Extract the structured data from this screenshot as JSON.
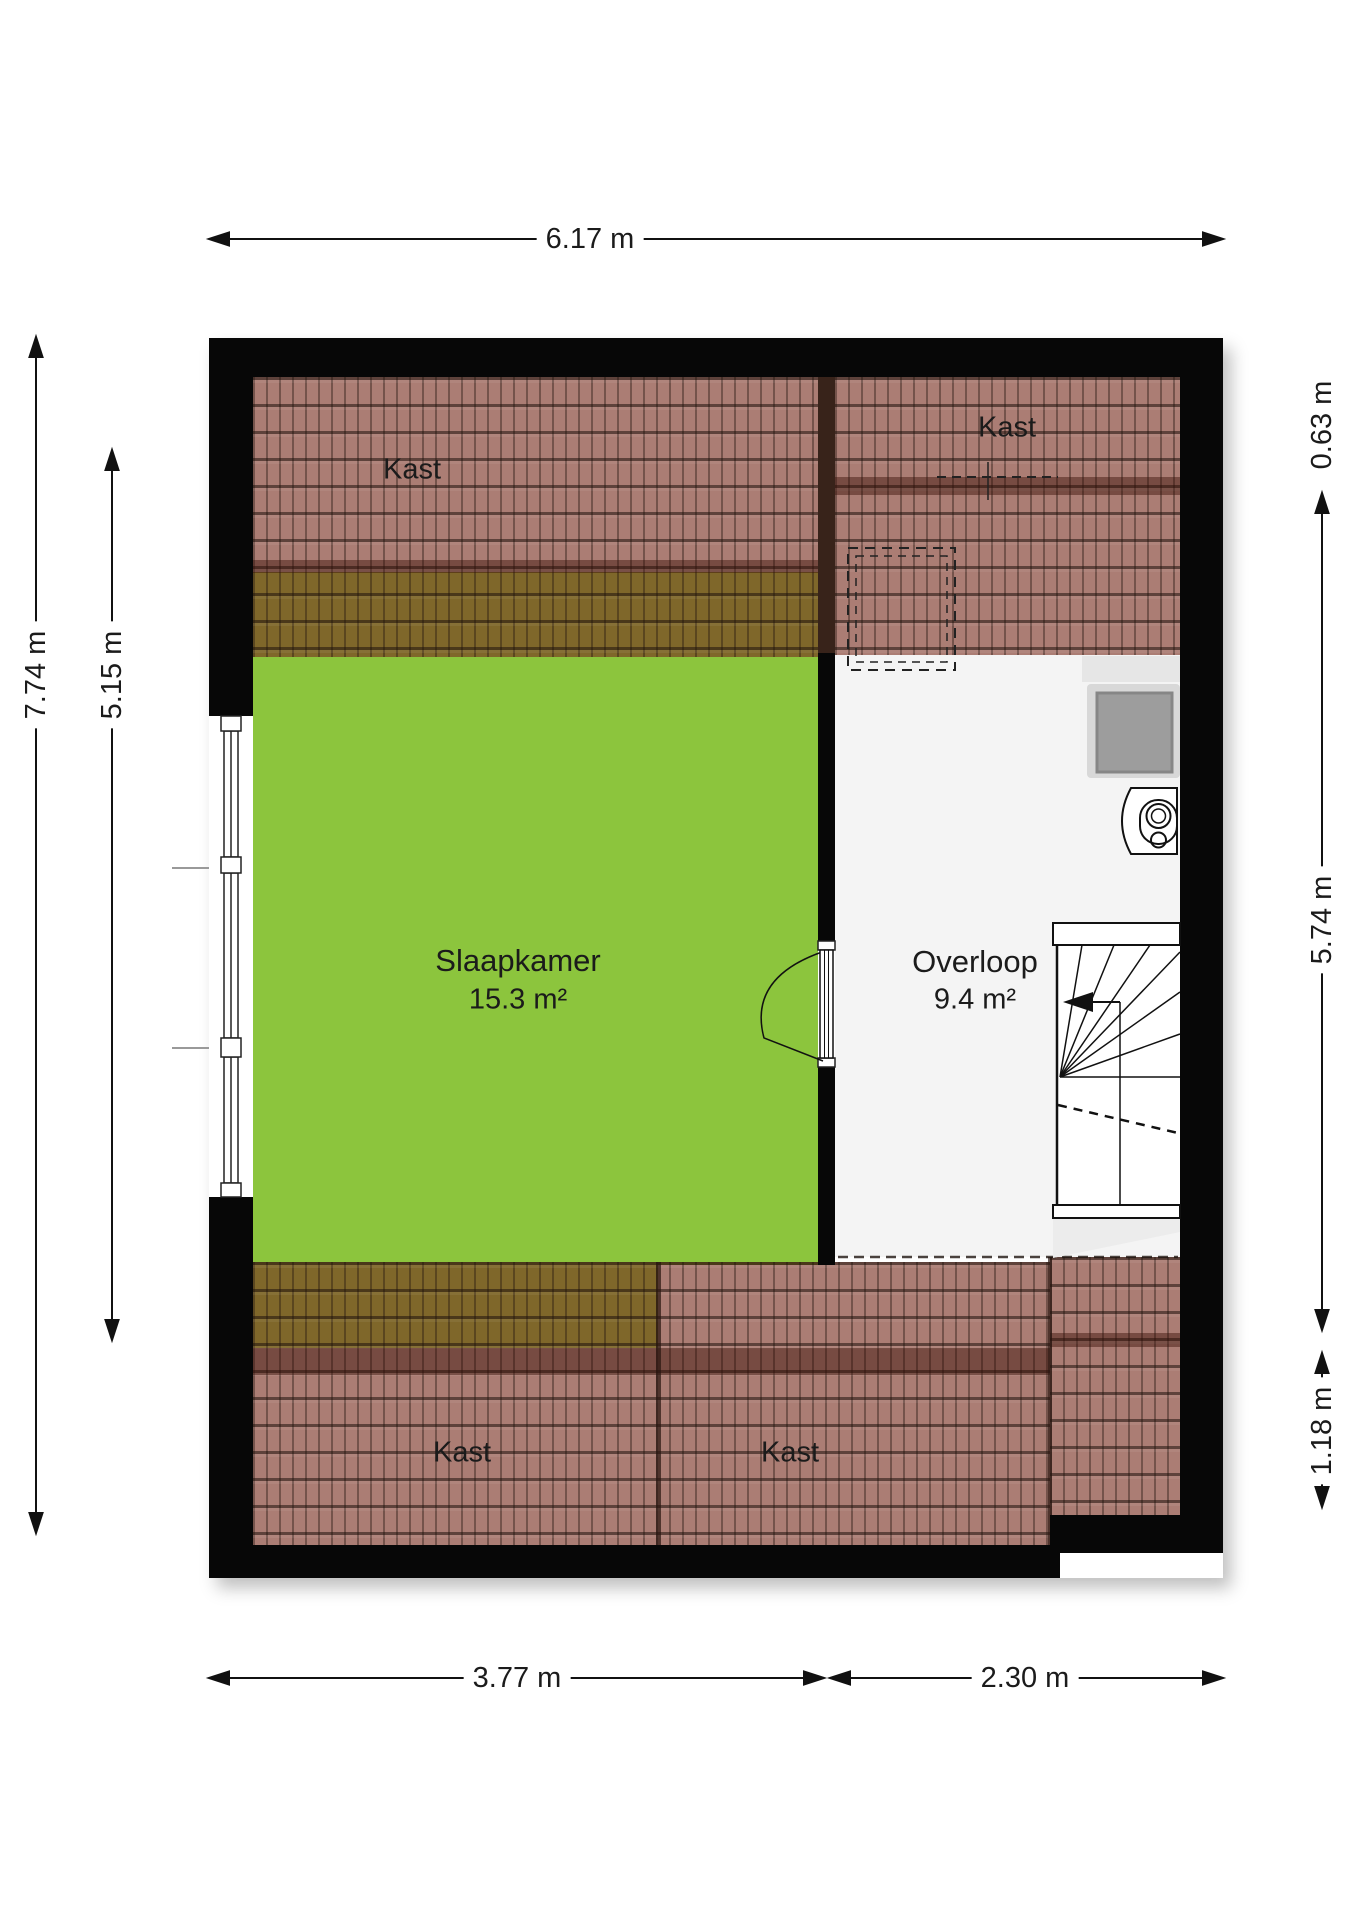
{
  "floorplan": {
    "rooms": [
      {
        "id": "slaapkamer",
        "name": "Slaapkamer",
        "area": "15.3 m²"
      },
      {
        "id": "overloop",
        "name": "Overloop",
        "area": "9.4 m²"
      }
    ],
    "closet_labels": [
      "Kast",
      "Kast",
      "Kast",
      "Kast"
    ],
    "dimensions": {
      "top": "6.17 m",
      "bottom_left": "3.77 m",
      "bottom_right": "2.30 m",
      "left_outer": "7.74 m",
      "left_inner": "5.15 m",
      "right_top": "0.63 m",
      "right_middle": "5.74 m",
      "right_bottom": "1.18 m"
    },
    "colors": {
      "room_green": "#8cc53d",
      "wall_black": "#070707",
      "floor_light": "#f4f4f4",
      "roof_tile_overlay": "rgba(120,45,30,0.62)",
      "dimension_text": "#111111"
    }
  }
}
